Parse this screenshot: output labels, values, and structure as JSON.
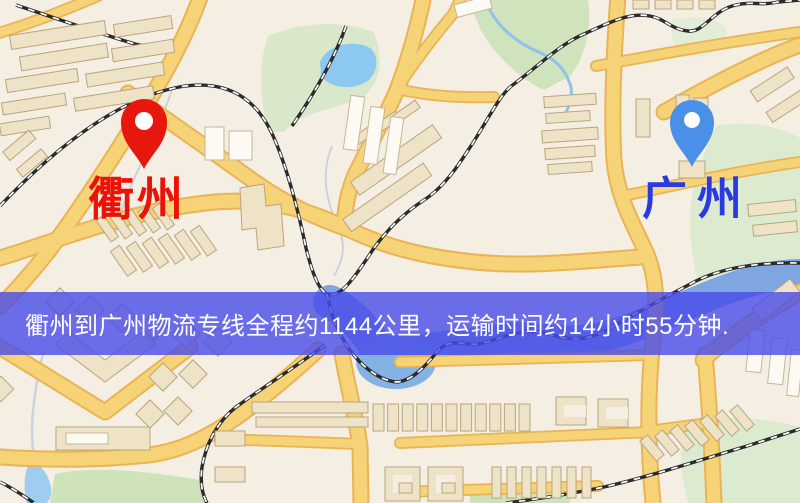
{
  "banner": {
    "text": "衢州到广州物流专线全程约1144公里，运输时间约14小时55分钟.",
    "bg_color": "rgba(73,75,233,0.8)",
    "text_color": "#ffffff"
  },
  "origin": {
    "label": "衢州",
    "pin_color": "#e8170d",
    "pin_hole_color": "#ffffff",
    "label_color": "#ed1208"
  },
  "destination": {
    "label": "广州",
    "pin_color": "#4a90e8",
    "pin_hole_color": "#ffffff",
    "label_color": "#2a3ae2"
  },
  "map_palette": {
    "background": "#f4eee3",
    "road_fill": "#f7d378",
    "road_casing": "#e8b455",
    "building": "#eee3c6",
    "building_white": "#fcfaf3",
    "park": "#dcead0",
    "water": "#8cc8f0",
    "river": "#7fa6e0",
    "railway": "#2b2b2b"
  }
}
